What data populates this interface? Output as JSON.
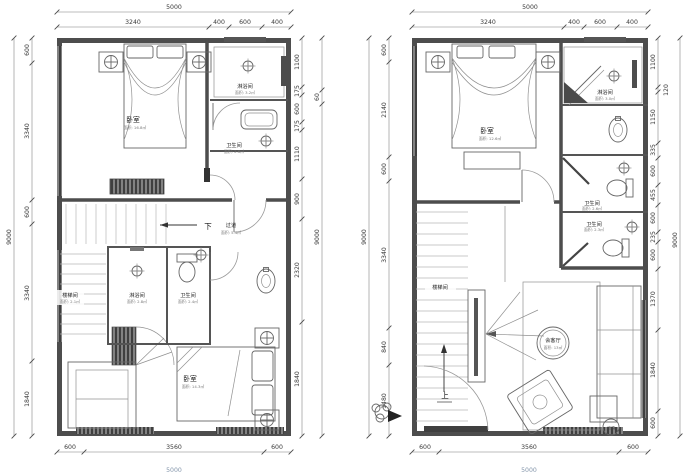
{
  "colors": {
    "wall": "#4d4d4d",
    "dim_line": "#777777",
    "text": "#333333",
    "faded_total": "#8496ab"
  },
  "left_plan": {
    "dim_top_total": "5000",
    "dim_top": [
      "3240",
      "400",
      "600",
      "400"
    ],
    "dim_left_total": "9000",
    "dim_left": [
      "600",
      "3340",
      "600",
      "3340",
      "1840"
    ],
    "dim_right": [
      "1100",
      "175",
      "600",
      "175",
      "1110",
      "900",
      "2320",
      "1840"
    ],
    "dim_right_total": "9000",
    "dim_right_offset": "60",
    "dim_bottom": [
      "600",
      "3560",
      "600"
    ],
    "dim_bottom_total": "5000",
    "rooms": {
      "bedroom_top": {
        "label": "卧室",
        "area": "面积: 16.8㎡"
      },
      "shower_top": {
        "label": "淋浴间",
        "area": "面积: 3.2㎡"
      },
      "bath_top": {
        "label": "卫生间",
        "area": "面积: 2.6㎡"
      },
      "corridor": {
        "label": "过道",
        "area": "面积: 5.4㎡"
      },
      "stairwell": {
        "label": "楼梯间",
        "area": "面积: 2.1㎡"
      },
      "shower_mid": {
        "label": "淋浴间",
        "area": "面积: 2.8㎡"
      },
      "bath_mid": {
        "label": "卫生间",
        "area": "面积: 2.4㎡"
      },
      "bedroom_bottom": {
        "label": "卧室",
        "area": "面积: 14.3㎡"
      }
    },
    "notes": {
      "down": "下"
    }
  },
  "right_plan": {
    "dim_top_total": "5000",
    "dim_top": [
      "3240",
      "400",
      "600",
      "400"
    ],
    "dim_left_total": "9000",
    "dim_left": [
      "600",
      "2140",
      "600",
      "3340",
      "840",
      "1480"
    ],
    "dim_right": [
      "1100",
      "120",
      "1150",
      "335",
      "600",
      "455",
      "600",
      "235",
      "600",
      "1370",
      "1840",
      "600"
    ],
    "dim_right_total": "9000",
    "dim_bottom": [
      "600",
      "3560",
      "600"
    ],
    "dim_bottom_total": "5000",
    "rooms": {
      "bedroom": {
        "label": "卧室",
        "area": "面积: 12.6㎡"
      },
      "shower": {
        "label": "淋浴间",
        "area": "面积: 3.0㎡"
      },
      "bath_upper": {
        "label": "卫生间",
        "area": "面积: 2.6㎡"
      },
      "bath_lower": {
        "label": "卫生间",
        "area": "面积: 2.3㎡"
      },
      "stairwell": {
        "label": "楼梯间"
      },
      "living": {
        "label": "会客厅",
        "area": "面积: 13㎡"
      }
    },
    "notes": {
      "up": "上",
      "ac": "空调"
    }
  }
}
